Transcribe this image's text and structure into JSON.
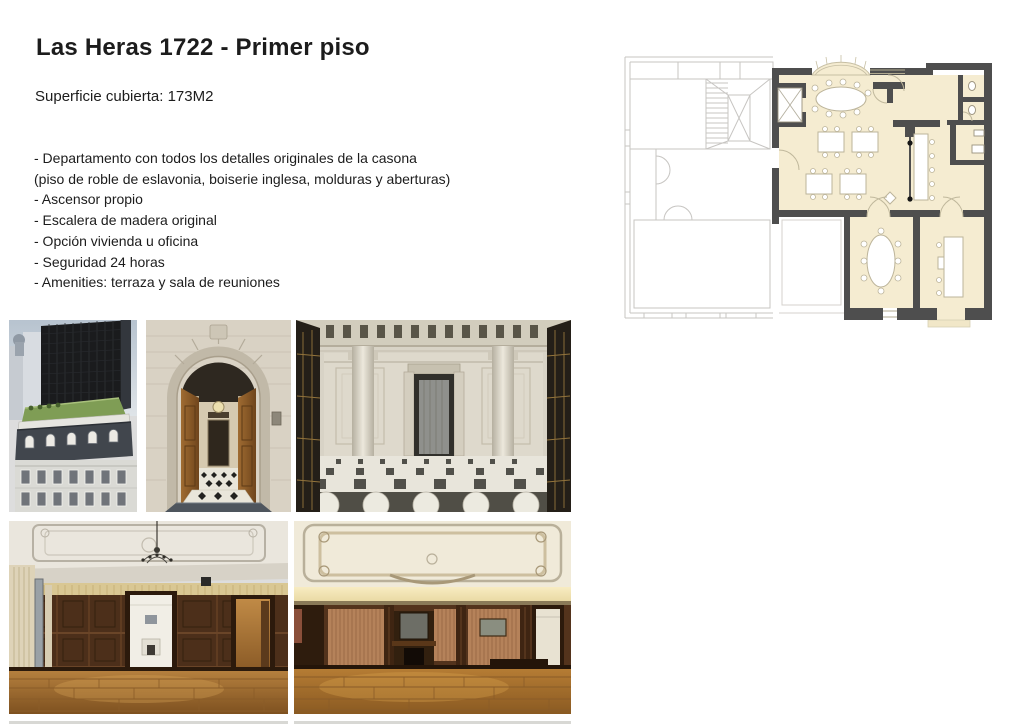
{
  "page": {
    "background": "#ffffff"
  },
  "header": {
    "title": "Las Heras 1722 - Primer piso",
    "subtitle": "Superficie cubierta: 173M2"
  },
  "features": [
    "- Departamento con todos los detalles originales de la casona",
    "(piso de roble de eslavonia, boiserie inglesa, molduras y aberturas)",
    "- Ascensor propio",
    "- Escalera de madera original",
    "- Opción vivienda u oficina",
    "- Seguridad 24 horas",
    "- Amenities: terraza y sala de reuniones"
  ],
  "floor_plan": {
    "label": "first-floor-plan",
    "unit_fill_color": "#f5ecd1",
    "wall_color": "#4e4e4e",
    "ghost_outline_color": "#c7c5c2"
  },
  "photos": [
    {
      "name": "building-exterior-aerial"
    },
    {
      "name": "entrance-arch-doors"
    },
    {
      "name": "marble-entrance-hall"
    },
    {
      "name": "wood-paneled-salon"
    },
    {
      "name": "ornate-ceiling-salon"
    }
  ]
}
